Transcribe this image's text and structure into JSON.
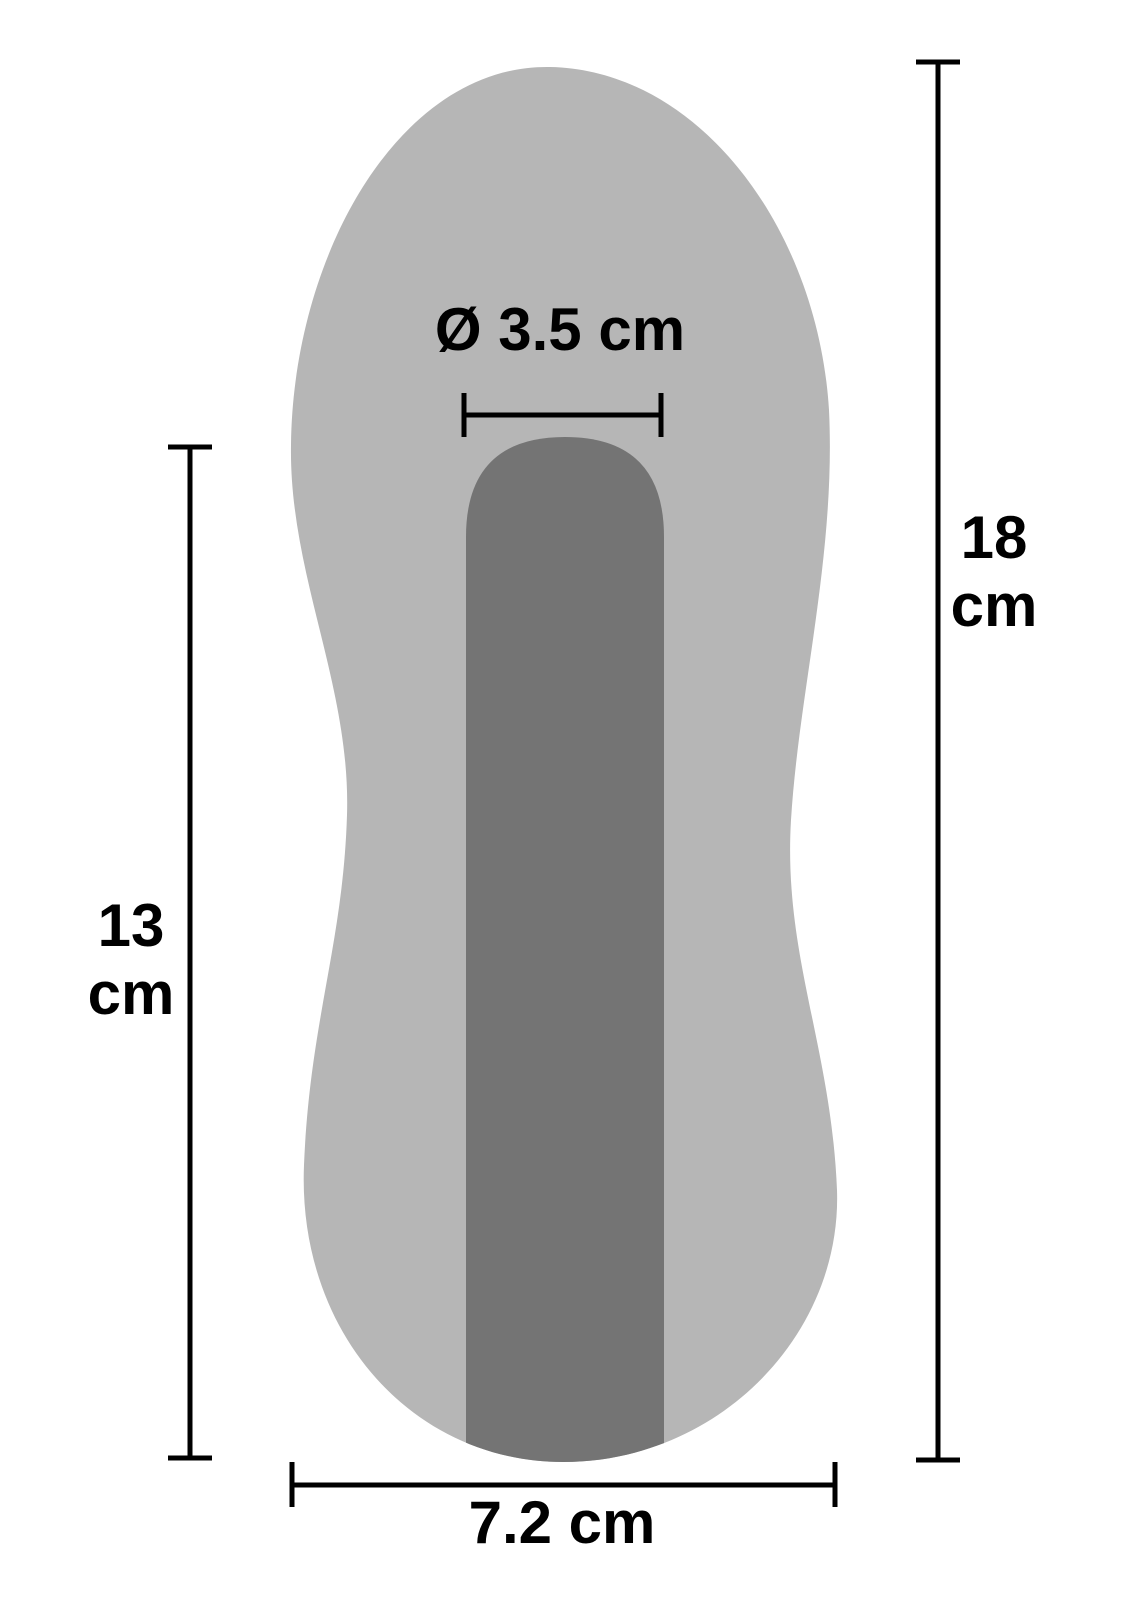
{
  "colors": {
    "background": "#ffffff",
    "body": "#b6b6b6",
    "channel": "#747474",
    "dimension_line": "#000000",
    "text": "#000000"
  },
  "measurements": {
    "inner_diameter": {
      "label": "Ø 3.5 cm"
    },
    "total_length": {
      "value": "18",
      "unit": "cm"
    },
    "inner_depth": {
      "value": "13",
      "unit": "cm"
    },
    "width": {
      "label": "7.2 cm"
    }
  }
}
